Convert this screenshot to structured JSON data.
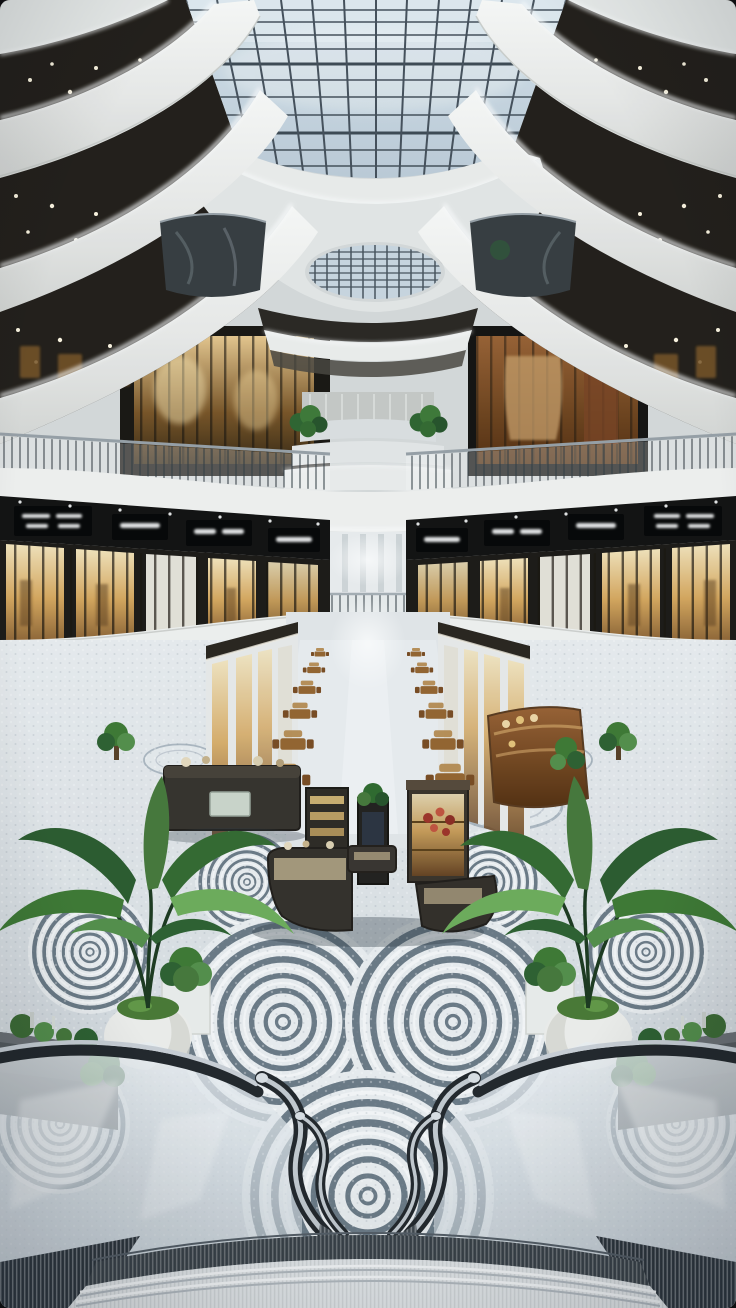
{
  "scene": {
    "type": "photograph",
    "setting": "Modern multi-level luxury shopping mall atrium with skylight, curved LED balconies, mosaic swirl floor, kiosks, plants, escalators and a wide staircase",
    "labels": {
      "photo": "Mall atrium photograph",
      "skylight": "Glass grid skylight",
      "skylight_echo": "Secondary oval skylight opening",
      "ceiling": "Dark recessed ceiling with warm spotlights",
      "balcony_bands": "Curved white balcony fascias with LED cove lighting",
      "glass_pod": "Curved dark glass balcony pod",
      "terraces": "Stacked central terraces with hanging plants",
      "upper_shop_left": "Upper-level boutique with amber glass front",
      "upper_shop_right": "Upper-level boutique with wood interior",
      "railing": "Glass balustrade with slim balusters",
      "sign_band": "Dark storefront sign band with white logos",
      "storefronts": "Illuminated storefront windows",
      "bridge_rail": "Second-level walkway glass rail",
      "corridor": "Ground-floor promenade receding to a bright vanishing point",
      "cafe_tables": "Rows of wooden cafe tables and chairs",
      "kiosks": "Central retail kiosks with lit display cases",
      "wood_kiosk": "Curved wooden retail kiosk",
      "counter_kiosk": "Dark rectangular display counter",
      "floor": "Mosaic terrazzo floor with concentric swirl medallions",
      "plant_left": "Tropical plant in round white planter (left)",
      "plant_right": "Tropical plant in round white planter (right)",
      "shrub": "Shrub in white cube planter",
      "corner_planter": "Gray corner planter box with greenery",
      "escalator_left": "Escalator with curved glass balustrade (left)",
      "escalator_right": "Escalator with curved glass balustrade (right)",
      "staircase": "Wide curved staircase in the foreground",
      "end_glow": "Bright corridor end glow"
    },
    "palette": {
      "skylight_glass": "#ccd9e3",
      "mullion": "#46515b",
      "band_white": "#f2f3f1",
      "ceiling_dark": "#231e18",
      "shop_warm": "#d9a95e",
      "wood": "#8a5a2e",
      "floor_light": "#e7eaec",
      "floor_swirl": "#6d7b87",
      "leaf_green": "#3f7a33",
      "planter_gray": "#5b6063",
      "handrail_dark": "#24282c",
      "chrome": "#c9cfd5"
    }
  }
}
